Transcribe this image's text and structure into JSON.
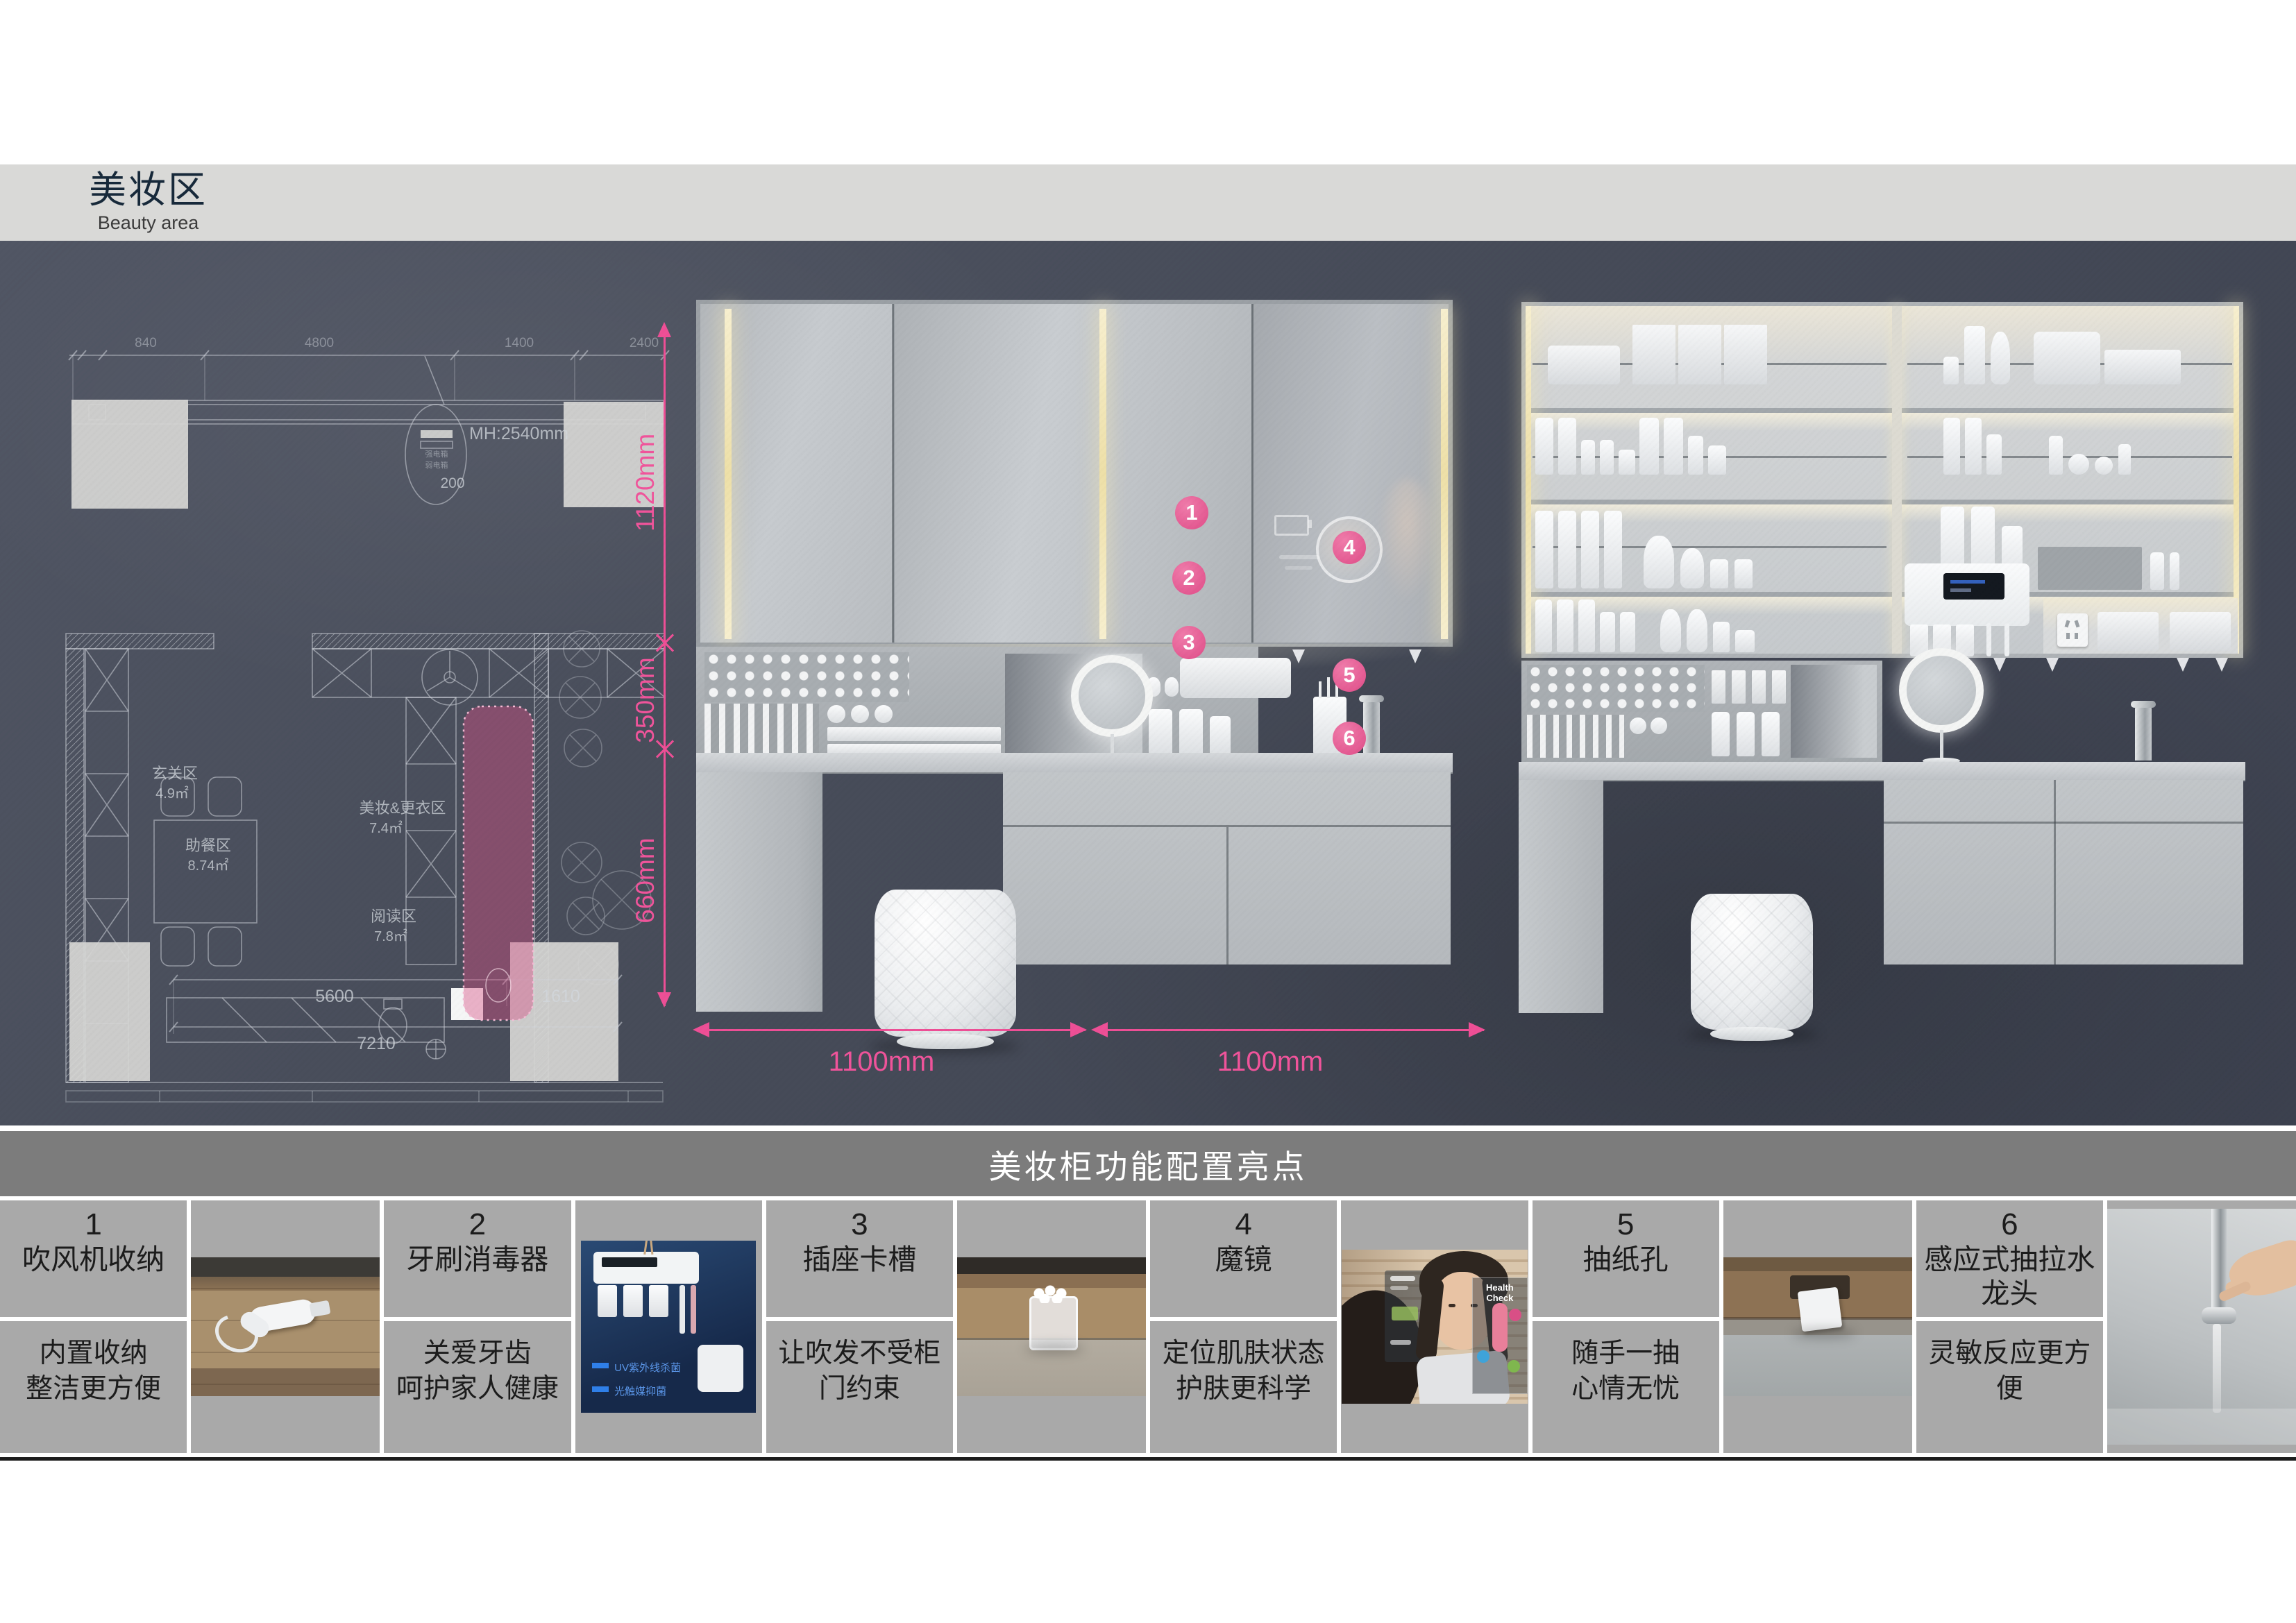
{
  "page": {
    "title": "美妆区",
    "subtitle": "Beauty area"
  },
  "colors": {
    "accent_pink": "#ee4f96",
    "marker_pink": "#df4c88",
    "slate_background": "#474c59",
    "header_band": "#d9d9d7",
    "table_header_bg": "#7c7c7c",
    "table_cell_bg": "#a9a9a9",
    "cabinet_gray": "#bfc3c7",
    "led_warm": "#f2e7bd"
  },
  "floor_plan": {
    "top_dims": [
      "840",
      "4800",
      "1400",
      "2400"
    ],
    "mh_label": "MH:2540mm",
    "circle_note": "200",
    "box_labels": [
      "强电箱",
      "弱电箱"
    ],
    "rooms": [
      {
        "name": "玄关区",
        "area": "4.9㎡"
      },
      {
        "name": "美妆&更衣区",
        "area": "7.4㎡"
      },
      {
        "name": "助餐区",
        "area": "8.74㎡"
      },
      {
        "name": "阅读区",
        "area": "7.8㎡"
      }
    ],
    "bottom_dims": [
      "5600",
      "1610",
      "7210"
    ]
  },
  "dimensions": {
    "height_top": "1120mm",
    "height_mid": "350mm",
    "height_bottom": "660mm",
    "width_left": "1100mm",
    "width_right": "1100mm"
  },
  "markers": [
    "1",
    "2",
    "3",
    "4",
    "5",
    "6"
  ],
  "features": {
    "header": "美妆柜功能配置亮点",
    "items": [
      {
        "num": "1",
        "title": "吹风机收纳",
        "desc": "内置收纳\n整洁更方便"
      },
      {
        "num": "2",
        "title": "牙刷消毒器",
        "desc": "关爱牙齿\n呵护家人健康"
      },
      {
        "num": "3",
        "title": "插座卡槽",
        "desc": "让吹发不受柜\n门约束"
      },
      {
        "num": "4",
        "title": "魔镜",
        "desc": "定位肌肤状态\n护肤更科学"
      },
      {
        "num": "5",
        "title": "抽纸孔",
        "desc": "随手一抽\n心情无忧"
      },
      {
        "num": "6",
        "title": "感应式抽拉水\n龙头",
        "desc": "灵敏反应更方\n便"
      }
    ],
    "photo2_captions": [
      "UV紫外线杀菌",
      "光触媒抑菌"
    ],
    "photo4_caption": "Health Check"
  }
}
